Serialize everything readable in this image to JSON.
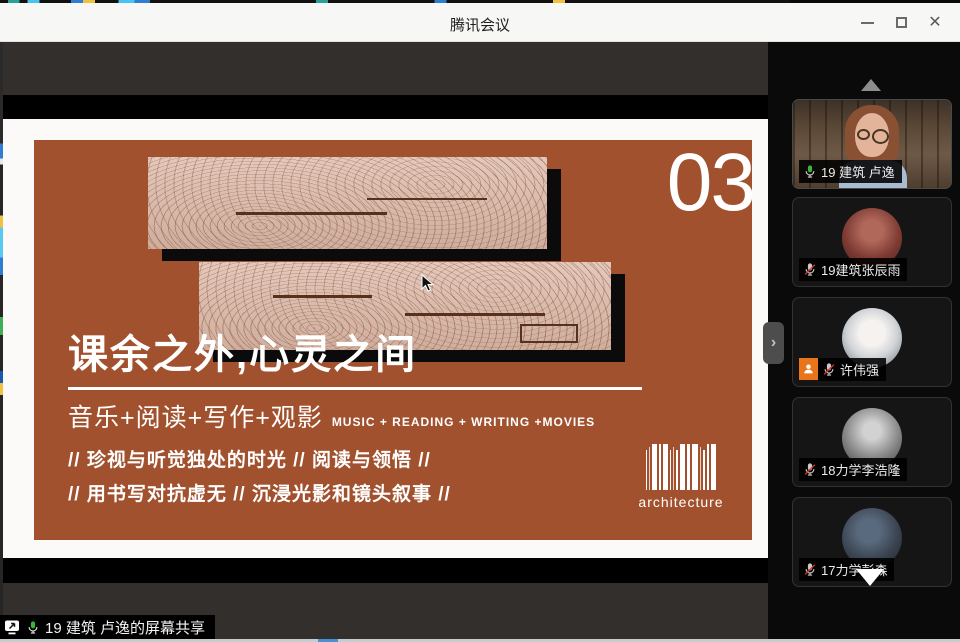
{
  "window": {
    "title": "腾讯会议",
    "controls": {
      "minimize": "minimize",
      "maximize": "maximize",
      "close": "✕"
    }
  },
  "slide": {
    "page_number": "03",
    "title": "课余之外,心灵之间",
    "subtitle_cn": "音乐+阅读+写作+观影",
    "subtitle_en": "MUSIC + READING + WRITING +MOVIES",
    "bullet_line1": "// 珍视与听觉独处的时光 // 阅读与领悟 //",
    "bullet_line2": "// 用书写对抗虚无 // 沉浸光影和镜头叙事 //",
    "barcode_caption": "architecture",
    "colors": {
      "background": "#a2512e",
      "text": "#ffffff"
    }
  },
  "participants": [
    {
      "name": "19 建筑 卢逸",
      "mic": "on",
      "tile": "video"
    },
    {
      "name": "19建筑张辰雨",
      "mic": "muted",
      "tile": "avatar"
    },
    {
      "name": "许伟强",
      "mic": "muted",
      "tile": "avatar",
      "badge": "member"
    },
    {
      "name": "18力学李浩隆",
      "mic": "muted",
      "tile": "avatar"
    },
    {
      "name": "17力学彭森",
      "mic": "muted",
      "tile": "avatar"
    }
  ],
  "status_bar": {
    "text": "19 建筑 卢逸的屏幕共享"
  },
  "colors": {
    "mic_active": "#3bb33b",
    "mic_muted_slash": "#d63a2f",
    "badge_orange": "#e8751a",
    "titlebar_bg": "#f7f7f6",
    "share_dark_bar": "#332f2c"
  }
}
